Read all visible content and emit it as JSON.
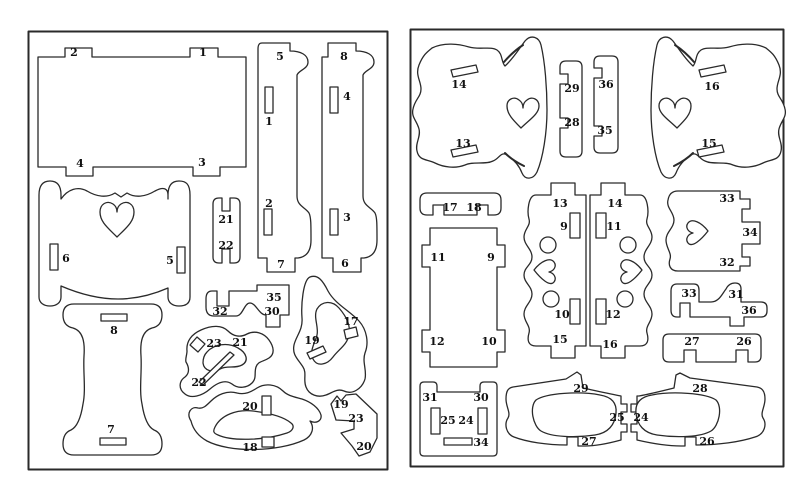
{
  "colors": {
    "line": "#2a2a2a",
    "background": "#ffffff",
    "label": "#111111"
  },
  "panels": [
    {
      "id": "left-sheet",
      "labels": [
        {
          "text": "2",
          "x": 74,
          "y": 52
        },
        {
          "text": "1",
          "x": 203,
          "y": 52
        },
        {
          "text": "4",
          "x": 80,
          "y": 163
        },
        {
          "text": "3",
          "x": 202,
          "y": 162
        },
        {
          "text": "5",
          "x": 280,
          "y": 56
        },
        {
          "text": "8",
          "x": 344,
          "y": 56
        },
        {
          "text": "1",
          "x": 269,
          "y": 121
        },
        {
          "text": "2",
          "x": 269,
          "y": 203
        },
        {
          "text": "4",
          "x": 347,
          "y": 96
        },
        {
          "text": "3",
          "x": 347,
          "y": 217
        },
        {
          "text": "7",
          "x": 281,
          "y": 264
        },
        {
          "text": "6",
          "x": 345,
          "y": 263
        },
        {
          "text": "6",
          "x": 66,
          "y": 258
        },
        {
          "text": "5",
          "x": 170,
          "y": 260
        },
        {
          "text": "21",
          "x": 226,
          "y": 219
        },
        {
          "text": "22",
          "x": 226,
          "y": 245
        },
        {
          "text": "8",
          "x": 114,
          "y": 330
        },
        {
          "text": "7",
          "x": 111,
          "y": 429
        },
        {
          "text": "35",
          "x": 274,
          "y": 297
        },
        {
          "text": "30",
          "x": 272,
          "y": 311
        },
        {
          "text": "32",
          "x": 220,
          "y": 311
        },
        {
          "text": "23",
          "x": 214,
          "y": 343
        },
        {
          "text": "21",
          "x": 240,
          "y": 342
        },
        {
          "text": "22",
          "x": 199,
          "y": 382
        },
        {
          "text": "19",
          "x": 312,
          "y": 340
        },
        {
          "text": "17",
          "x": 351,
          "y": 321
        },
        {
          "text": "20",
          "x": 250,
          "y": 406
        },
        {
          "text": "18",
          "x": 250,
          "y": 447
        },
        {
          "text": "19",
          "x": 341,
          "y": 404
        },
        {
          "text": "23",
          "x": 356,
          "y": 418
        },
        {
          "text": "20",
          "x": 364,
          "y": 446
        }
      ]
    },
    {
      "id": "right-sheet",
      "labels": [
        {
          "text": "14",
          "x": 459,
          "y": 84
        },
        {
          "text": "13",
          "x": 463,
          "y": 143
        },
        {
          "text": "29",
          "x": 572,
          "y": 88
        },
        {
          "text": "28",
          "x": 572,
          "y": 122
        },
        {
          "text": "36",
          "x": 606,
          "y": 84
        },
        {
          "text": "35",
          "x": 605,
          "y": 130
        },
        {
          "text": "16",
          "x": 712,
          "y": 86
        },
        {
          "text": "15",
          "x": 709,
          "y": 143
        },
        {
          "text": "17",
          "x": 450,
          "y": 207
        },
        {
          "text": "18",
          "x": 474,
          "y": 207
        },
        {
          "text": "11",
          "x": 438,
          "y": 257
        },
        {
          "text": "9",
          "x": 491,
          "y": 257
        },
        {
          "text": "12",
          "x": 437,
          "y": 341
        },
        {
          "text": "10",
          "x": 489,
          "y": 341
        },
        {
          "text": "13",
          "x": 560,
          "y": 203
        },
        {
          "text": "14",
          "x": 615,
          "y": 203
        },
        {
          "text": "9",
          "x": 564,
          "y": 226
        },
        {
          "text": "11",
          "x": 614,
          "y": 226
        },
        {
          "text": "10",
          "x": 562,
          "y": 314
        },
        {
          "text": "12",
          "x": 613,
          "y": 314
        },
        {
          "text": "15",
          "x": 560,
          "y": 339
        },
        {
          "text": "16",
          "x": 610,
          "y": 344
        },
        {
          "text": "33",
          "x": 727,
          "y": 198
        },
        {
          "text": "34",
          "x": 750,
          "y": 232
        },
        {
          "text": "32",
          "x": 727,
          "y": 262
        },
        {
          "text": "33",
          "x": 689,
          "y": 293
        },
        {
          "text": "31",
          "x": 736,
          "y": 294
        },
        {
          "text": "36",
          "x": 749,
          "y": 310
        },
        {
          "text": "27",
          "x": 692,
          "y": 341
        },
        {
          "text": "26",
          "x": 744,
          "y": 341
        },
        {
          "text": "31",
          "x": 430,
          "y": 397
        },
        {
          "text": "30",
          "x": 481,
          "y": 397
        },
        {
          "text": "25",
          "x": 448,
          "y": 420
        },
        {
          "text": "24",
          "x": 466,
          "y": 420
        },
        {
          "text": "34",
          "x": 481,
          "y": 442
        },
        {
          "text": "29",
          "x": 581,
          "y": 388
        },
        {
          "text": "28",
          "x": 700,
          "y": 388
        },
        {
          "text": "25",
          "x": 617,
          "y": 417
        },
        {
          "text": "24",
          "x": 641,
          "y": 417
        },
        {
          "text": "27",
          "x": 589,
          "y": 441
        },
        {
          "text": "26",
          "x": 707,
          "y": 441
        }
      ]
    }
  ]
}
